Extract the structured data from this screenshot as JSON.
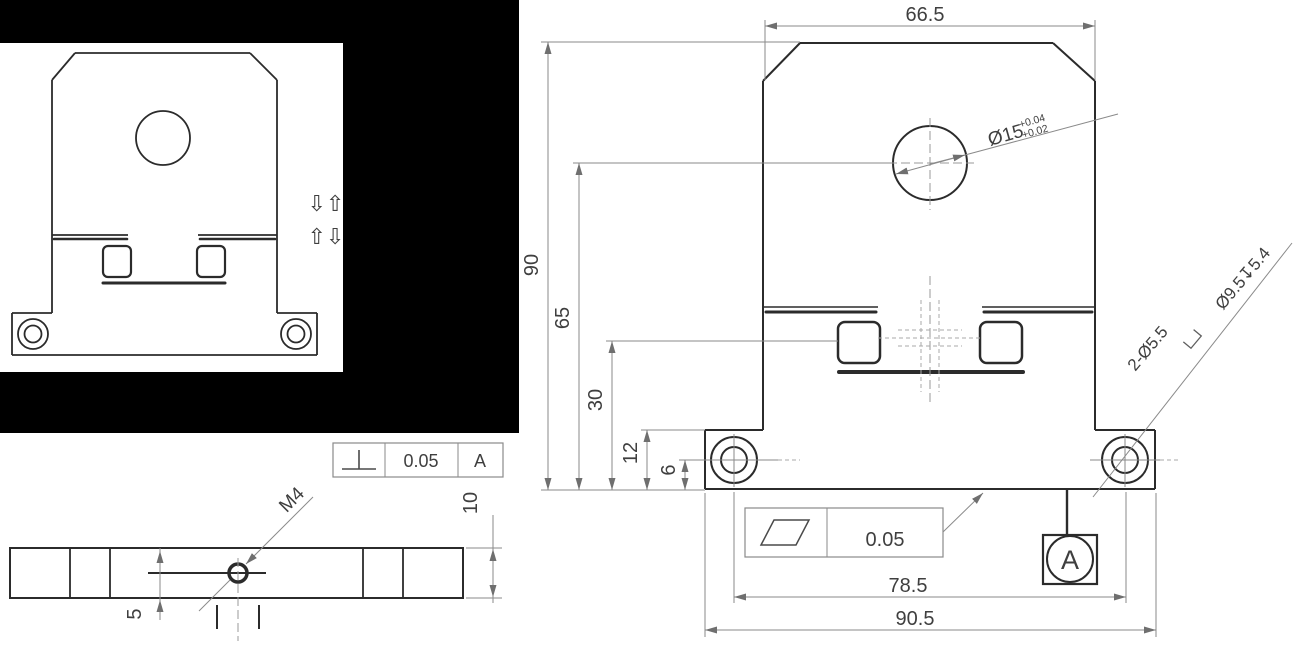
{
  "drawing": {
    "front_view_photo": {
      "arrows_row1": "⇩⇧",
      "arrows_row2": "⇧⇩"
    },
    "main_view": {
      "dim_top_width": "66.5",
      "dim_overall_height": "90",
      "dim_hole_center_from_bottom": "65",
      "dim_terminal_center_from_bottom": "30",
      "dim_base_step_height": "12",
      "dim_mount_hole_center_height": "6",
      "center_hole_diameter": "Ø15",
      "center_hole_tol_upper": "+0.04",
      "center_hole_tol_lower": "+0.02",
      "mount_hole_note": "2-Ø5.5",
      "mount_hole_counterbore_note": "Ø9.5↧5.4",
      "flatness_value": "0.05",
      "datum_label": "A",
      "dim_mount_hole_spacing": "78.5",
      "dim_overall_width": "90.5"
    },
    "side_view": {
      "thread_note": "M4",
      "dim_thread_offset": "5",
      "dim_plate_thickness": "10",
      "perpendicularity_value": "0.05",
      "perpendicularity_datum": "A"
    }
  },
  "colors": {
    "background": "#ffffff",
    "panel_backdrop": "#000000",
    "object_line": "#2b2b2b",
    "dimension_line": "#8a8a8a",
    "text": "#3f3f3f"
  }
}
